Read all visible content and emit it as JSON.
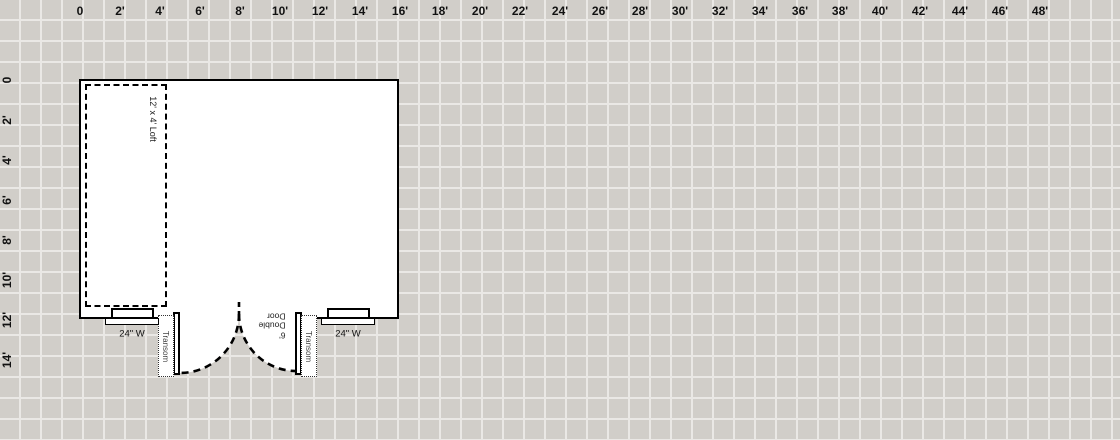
{
  "app": {
    "name": "floor-plan-design-canvas"
  },
  "rulers": {
    "top": {
      "labels": [
        "0",
        "2'",
        "4'",
        "6'",
        "8'",
        "10'",
        "12'",
        "14'",
        "16'",
        "18'",
        "20'",
        "22'",
        "24'",
        "26'",
        "28'",
        "30'",
        "32'",
        "34'",
        "36'",
        "38'",
        "40'",
        "42'",
        "44'",
        "46'",
        "48'"
      ]
    },
    "left": {
      "labels": [
        "0",
        "2'",
        "4'",
        "6'",
        "8'",
        "10'",
        "12'",
        "14'"
      ]
    }
  },
  "plan": {
    "building": {
      "width_ft": 16,
      "height_ft": 12
    },
    "loft": {
      "label": "12' x 4' Loft"
    },
    "windows": [
      {
        "label": "24\" W"
      },
      {
        "label": "24\" W"
      }
    ],
    "transoms": [
      {
        "label": "Transom"
      },
      {
        "label": "Transom"
      }
    ],
    "door": {
      "label": "6'\nDouble\nDoor"
    }
  },
  "colors": {
    "grid_cell": "#d1cec9",
    "grid_line": "#eae8e5",
    "wall": "#000000",
    "room_fill": "#ffffff",
    "label_text": "#111111"
  }
}
